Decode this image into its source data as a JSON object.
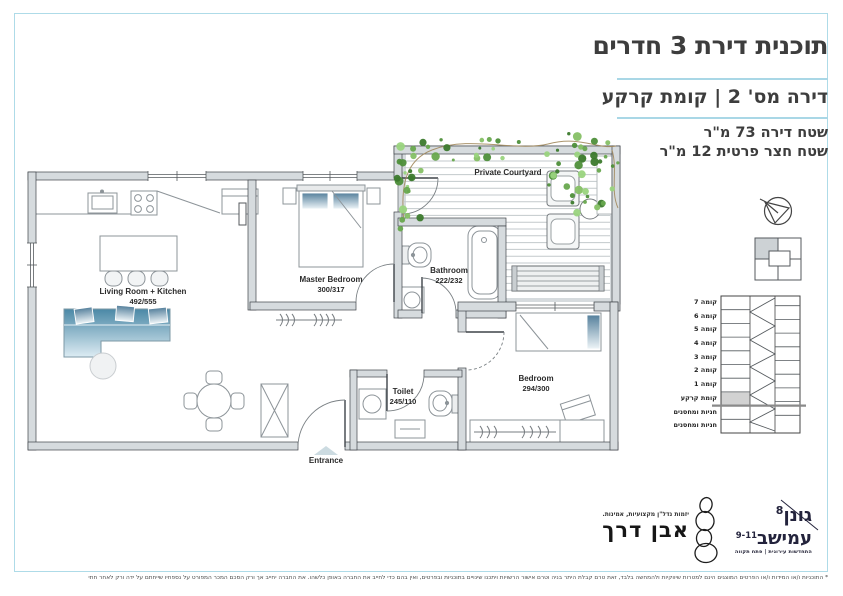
{
  "colors": {
    "accent_blue": "#a9d7e6",
    "frame_blue": "#aedbe8",
    "wall_fill": "#d6dbde",
    "sofa_blue": "#4a88a6",
    "ivy_green": "#5a9e3f",
    "highlight_gray": "#d2d2d2",
    "text_dark": "#3d3d3d"
  },
  "header": {
    "title": "תוכנית דירת 3 חדרים",
    "subtitle": "דירה מס' 2  |  קומת קרקע",
    "area_line1": "שטח דירה 73 מ\"ר",
    "area_line2": "שטח חצר פרטית 12 מ\"ר"
  },
  "plan": {
    "rooms": [
      {
        "name": "Living Room + Kitchen",
        "dims": "492/555"
      },
      {
        "name": "Master Bedroom",
        "dims": "300/317"
      },
      {
        "name": "Bathroom",
        "dims": "222/232"
      },
      {
        "name": "Toilet",
        "dims": "245/110"
      },
      {
        "name": "Bedroom",
        "dims": "294/300"
      },
      {
        "name": "Private Courtyard",
        "dims": ""
      }
    ],
    "entrance_label": "Entrance"
  },
  "sidebar": {
    "icons": [
      "north-compass-icon",
      "key-plan-diagram",
      "building-section-diagram"
    ],
    "floors": [
      "קומה 7",
      "קומה 6",
      "קומה 5",
      "קומה 4",
      "קומה 3",
      "קומה 2",
      "קומה 1",
      "קומת קרקע",
      "חניות ומחסנים",
      "חניות ומחסנים"
    ],
    "highlighted_floor": "קומת קרקע"
  },
  "footer": {
    "even_derech": {
      "name": "אבן דרך",
      "tagline": "יזמות נדל\"ן מקצועיות, אמינות."
    },
    "gonen": {
      "line1": "גונן",
      "line1_num": "8",
      "line2": "עמישב",
      "line2_num": "9-11",
      "tagline": "התחדשות עירונית | פתח תקווה"
    },
    "disclaimer": "* התוכניות ו/או המידות ו/או הפרטים המוצגים הינם למטרות שיווקיות ולהמחשה בלבד, זאת טרם קבלת היתר בניה וטרם אישור הרשויות ויתכנו שינויים בתוכניות ובפרטים, ואין בהם כדי לחייב את החברה באופן כלשהו. את החברה יחייב אך ורק הסכם המכר המפורט על נספחיו שייחתם על ידה ורק לאחר חתימתו על הסכם מכר כאמור."
  }
}
